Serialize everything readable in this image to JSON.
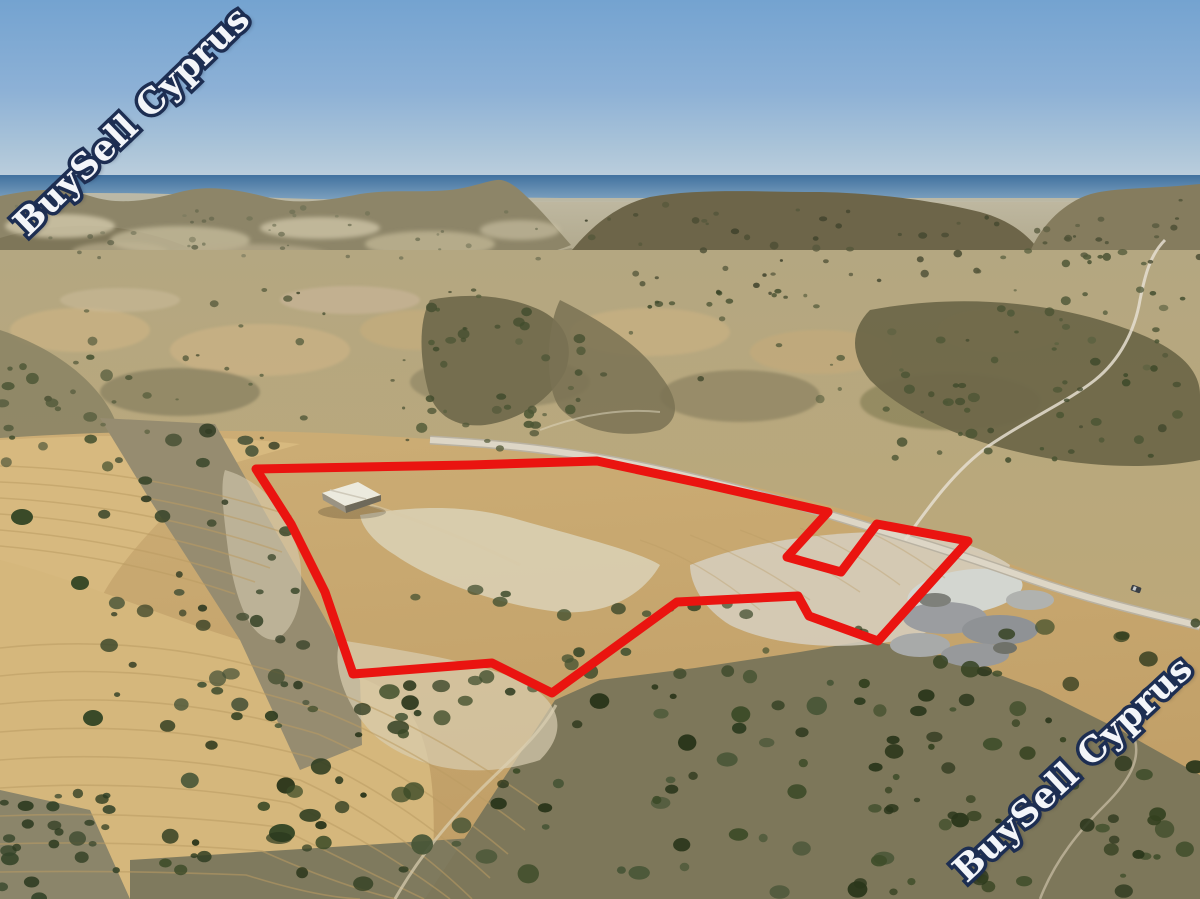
{
  "image_title": "Aerial drone view of a hillside land parcel for sale in Cyprus",
  "watermark": {
    "text": "BuySell Cyprus",
    "fill": "#f3f5f9",
    "outline": "#1d2e52"
  },
  "boundary": {
    "color": "#ea1410",
    "stroke_width": 9,
    "points": [
      [
        256,
        469
      ],
      [
        470,
        465
      ],
      [
        597,
        461
      ],
      [
        700,
        483
      ],
      [
        828,
        512
      ],
      [
        787,
        557
      ],
      [
        841,
        572
      ],
      [
        877,
        524
      ],
      [
        968,
        541
      ],
      [
        878,
        641
      ],
      [
        809,
        616
      ],
      [
        798,
        596
      ],
      [
        677,
        602
      ],
      [
        552,
        693
      ],
      [
        492,
        663
      ],
      [
        353,
        674
      ],
      [
        325,
        592
      ],
      [
        291,
        524
      ]
    ]
  },
  "colors": {
    "sky_top": "#74a3d0",
    "sky_horizon": "#c9d6e0",
    "sea_dark": "#41719f",
    "sea_light": "#7fa3c0",
    "terrain_tan": "#c9aa72",
    "field_gold": "#d7b97f",
    "scrub_green": "#35441f",
    "hill_olive": "#6d6549",
    "road_light": "#ddd6c6",
    "building_roof": "#eceade",
    "wm_fill": "#f3f5f9",
    "wm_outline": "#1d2e52"
  },
  "scene_objects": {
    "sea": "Mediterranean sea band on horizon",
    "building": "white gable-roof warehouse inside parcel",
    "road": "asphalt road crossing upper right of parcel",
    "car": "single dark car on road",
    "quarry": "grey spoil heaps beside road junction"
  }
}
